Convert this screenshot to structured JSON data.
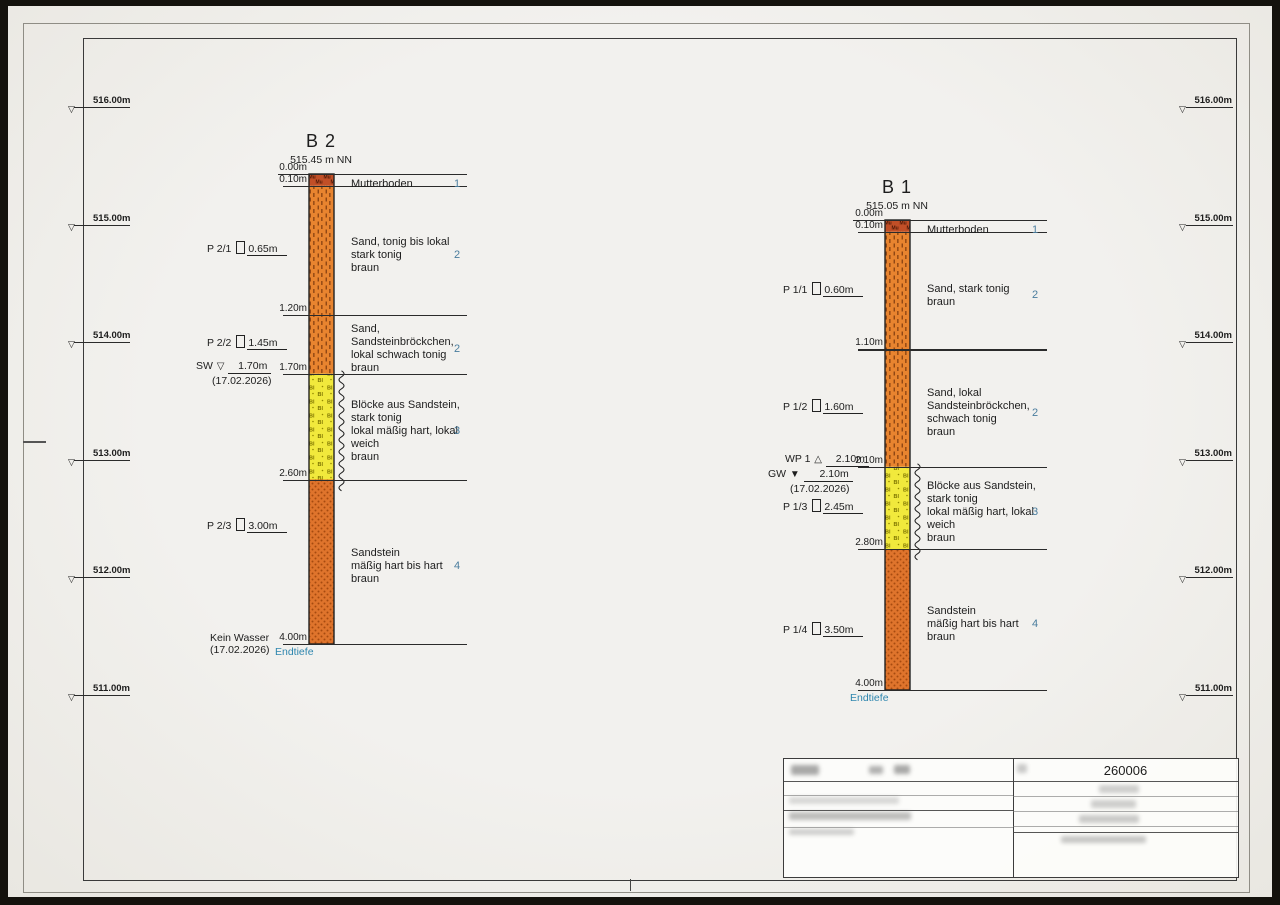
{
  "sheet": {
    "scale_ticks": [
      {
        "label": "516.00m",
        "elevation": 516.0
      },
      {
        "label": "515.00m",
        "elevation": 515.0
      },
      {
        "label": "514.00m",
        "elevation": 514.0
      },
      {
        "label": "513.00m",
        "elevation": 513.0
      },
      {
        "label": "512.00m",
        "elevation": 512.0
      },
      {
        "label": "511.00m",
        "elevation": 511.0
      }
    ],
    "boreholes": [
      {
        "title": "B 2",
        "elevation_label": "515.45 m NN",
        "boundaries": [
          {
            "depth": 0.0,
            "label": "0.00m"
          },
          {
            "depth": 0.1,
            "label": "0.10m"
          },
          {
            "depth": 1.2,
            "label": "1.20m"
          },
          {
            "depth": 1.7,
            "label": "1.70m"
          },
          {
            "depth": 2.6,
            "label": "2.60m"
          },
          {
            "depth": 4.0,
            "label": "4.00m"
          }
        ],
        "layers": [
          {
            "from": 0.0,
            "to": 0.1,
            "pattern": "topsoil",
            "description": [
              "Mutterboden"
            ],
            "number": "1"
          },
          {
            "from": 0.1,
            "to": 1.2,
            "pattern": "sand",
            "description": [
              "Sand, tonig bis lokal",
              "stark tonig",
              "braun"
            ],
            "number": "2"
          },
          {
            "from": 1.2,
            "to": 1.7,
            "pattern": "sand",
            "description": [
              "Sand,",
              "Sandsteinbröckchen,",
              "lokal schwach tonig",
              "braun"
            ],
            "number": "2"
          },
          {
            "from": 1.7,
            "to": 2.6,
            "pattern": "blocks",
            "description": [
              "Blöcke aus Sandstein,",
              "stark tonig",
              "lokal mäßig hart, lokal",
              "weich",
              "braun"
            ],
            "number": "3"
          },
          {
            "from": 2.6,
            "to": 4.0,
            "pattern": "sandstone",
            "description": [
              "Sandstein",
              "mäßig hart bis hart",
              "braun"
            ],
            "number": "4"
          }
        ],
        "samples": [
          {
            "label": "P 2/1",
            "depth": 0.65,
            "depth_label": "0.65m"
          },
          {
            "label": "P 2/2",
            "depth": 1.45,
            "depth_label": "1.45m"
          },
          {
            "label": "P 2/3",
            "depth": 3.0,
            "depth_label": "3.00m"
          }
        ],
        "water_markers": [
          {
            "label": "SW",
            "symbol": "open-down",
            "depth": 1.7,
            "depth_label": "1.70m",
            "date": "(17.02.2026)"
          }
        ],
        "bottom_note": [
          "Kein Wasser",
          "(17.02.2026)"
        ],
        "end_label": "Endtiefe"
      },
      {
        "title": "B 1",
        "elevation_label": "515.05 m NN",
        "boundaries": [
          {
            "depth": 0.0,
            "label": "0.00m"
          },
          {
            "depth": 0.1,
            "label": "0.10m"
          },
          {
            "depth": 1.1,
            "label": "1.10m"
          },
          {
            "depth": 2.1,
            "label": "2.10m"
          },
          {
            "depth": 2.8,
            "label": "2.80m"
          },
          {
            "depth": 4.0,
            "label": "4.00m"
          }
        ],
        "layers": [
          {
            "from": 0.0,
            "to": 0.1,
            "pattern": "topsoil",
            "description": [
              "Mutterboden"
            ],
            "number": "1"
          },
          {
            "from": 0.1,
            "to": 1.1,
            "pattern": "sand",
            "description": [
              "Sand, stark tonig",
              "braun"
            ],
            "number": "2"
          },
          {
            "from": 1.1,
            "to": 2.1,
            "pattern": "sand",
            "description": [
              "Sand, lokal",
              "Sandsteinbröckchen,",
              "schwach tonig",
              "braun"
            ],
            "number": "2"
          },
          {
            "from": 2.1,
            "to": 2.8,
            "pattern": "blocks",
            "description": [
              "Blöcke aus Sandstein,",
              "stark tonig",
              "lokal mäßig hart, lokal",
              "weich",
              "braun"
            ],
            "number": "3"
          },
          {
            "from": 2.8,
            "to": 4.0,
            "pattern": "sandstone",
            "description": [
              "Sandstein",
              "mäßig hart bis hart",
              "braun"
            ],
            "number": "4"
          }
        ],
        "samples": [
          {
            "label": "P 1/1",
            "depth": 0.6,
            "depth_label": "0.60m"
          },
          {
            "label": "P 1/2",
            "depth": 1.6,
            "depth_label": "1.60m"
          },
          {
            "label": "P 1/3",
            "depth": 2.45,
            "depth_label": "2.45m"
          },
          {
            "label": "P 1/4",
            "depth": 3.5,
            "depth_label": "3.50m"
          }
        ],
        "water_markers": [
          {
            "label": "WP 1",
            "symbol": "open-up",
            "depth": 2.1,
            "depth_label": "2.10m"
          },
          {
            "label": "GW",
            "symbol": "filled-down",
            "depth": 2.1,
            "depth_label": "2.10m",
            "date": "(17.02.2026)"
          }
        ],
        "end_label": "Endtiefe"
      }
    ],
    "title_block": {
      "number": "260006"
    },
    "colors": {
      "sand": "#e8842f",
      "sandstone": "#df742c",
      "blocks": "#f1e93c",
      "topsoil": "#c14f27",
      "layer_number": "#4a7d9e",
      "end_label": "#2e86ae",
      "line": "#2b2b2b"
    }
  }
}
